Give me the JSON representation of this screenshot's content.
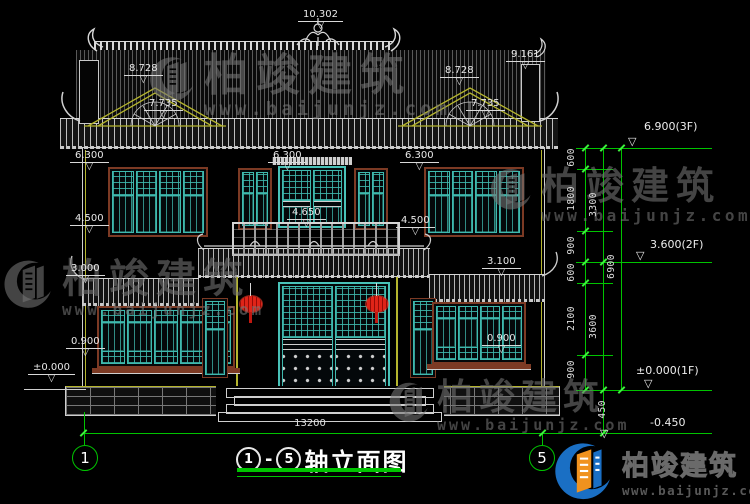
{
  "levels": {
    "peak": "10.302",
    "gable_left": [
      "8.728",
      "7.735"
    ],
    "gable_right": [
      "8.728",
      "7.735"
    ],
    "roof_tip_right": "9.161",
    "eave": [
      "6.300",
      "6.300",
      "6.300"
    ],
    "win2": [
      "4.500",
      "4.500"
    ],
    "balcony": "4.650",
    "porch": [
      "3.000",
      "3.100"
    ],
    "win1": [
      "0.900",
      "0.900"
    ],
    "ground": "±0.000"
  },
  "floor_marks": {
    "f3": "6.900(3F)",
    "f2": "3.600(2F)",
    "f1": "±0.000(1F)",
    "foundation": "-0.450"
  },
  "dims": {
    "inner": [
      "600",
      "1800",
      "900",
      "600",
      "2100",
      "900"
    ],
    "mid": [
      "3300",
      "3600",
      "450"
    ],
    "outer": "6900",
    "width": "13200"
  },
  "axes": {
    "left": "1",
    "right": "5"
  },
  "title": {
    "start": "1",
    "dash": "-",
    "end": "5",
    "text": "轴立面图"
  },
  "brand": {
    "name": "柏竣建筑",
    "url": "www.baijunjz.com"
  }
}
